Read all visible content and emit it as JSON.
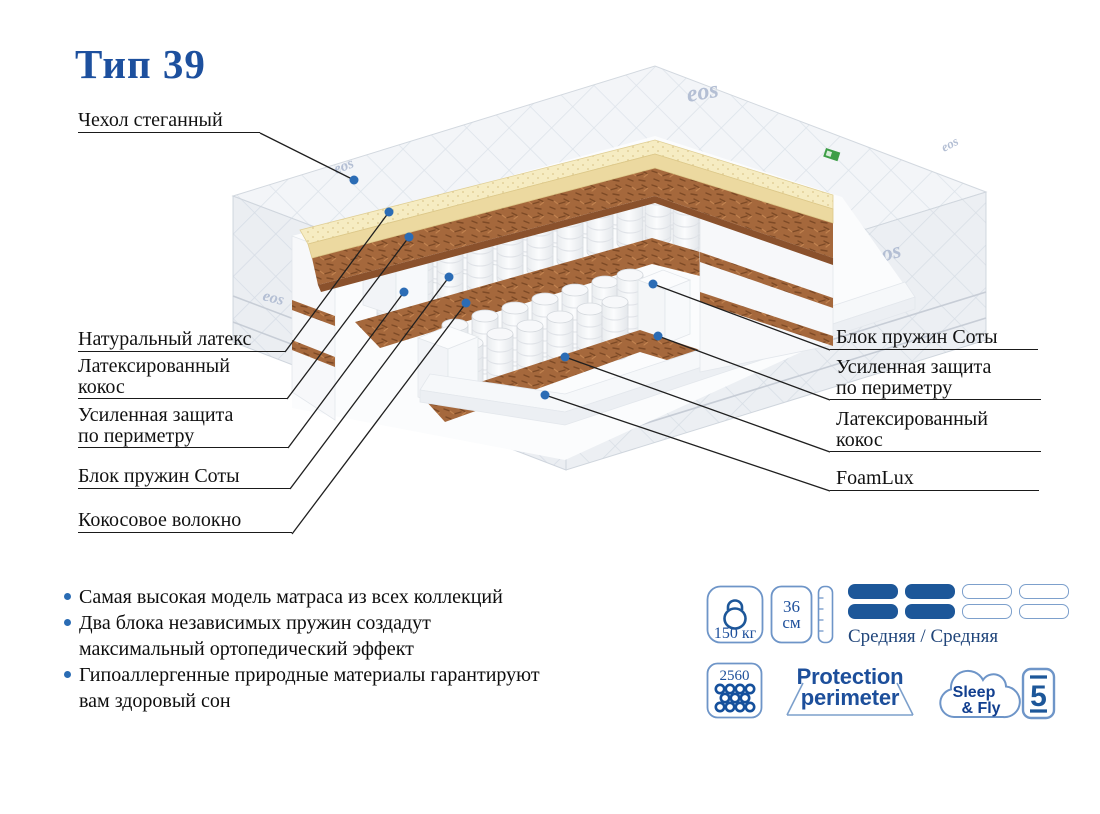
{
  "title": "Тип 39",
  "fabric_brand": "eos",
  "labels_left": [
    {
      "text": "Чехол стеганный"
    },
    {
      "text": "Натуральный латекс"
    },
    {
      "text": "Латексированный\nкокос"
    },
    {
      "text": "Усиленная защита\nпо периметру"
    },
    {
      "text": "Блок пружин Соты"
    },
    {
      "text": "Кокосовое волокно"
    }
  ],
  "labels_right": [
    {
      "text": "Блок пружин Соты"
    },
    {
      "text": "Усиленная защита\nпо периметру"
    },
    {
      "text": "Латексированный\nкокос"
    },
    {
      "text": "FoamLux"
    }
  ],
  "bullets": [
    {
      "text": "Самая высокая модель матраса из всех коллекций"
    },
    {
      "text": "Два блока независимых пружин создадут\nмаксимальный ортопедический эффект"
    },
    {
      "text": "Гипоаллергенные природные материалы гарантируют\nвам здоровый сон"
    }
  ],
  "badges": {
    "max_weight": "150 кг",
    "height_value": "36",
    "height_unit": "см",
    "springs_count": "2560",
    "firmness": "Средняя / Средняя",
    "protection_line1": "Protection",
    "protection_line2": "perimeter",
    "brand_line1": "Sleep",
    "brand_line2": "& Fly",
    "warranty_years": "5"
  },
  "colors": {
    "accent_blue": "#1d509e",
    "badge_outline": "#6e95c8",
    "firmness_fill": "#1d5799",
    "latex_yellow": "#f6ecc2",
    "coir_brown": "#a5683c",
    "dot_blue": "#2b6cb5"
  }
}
